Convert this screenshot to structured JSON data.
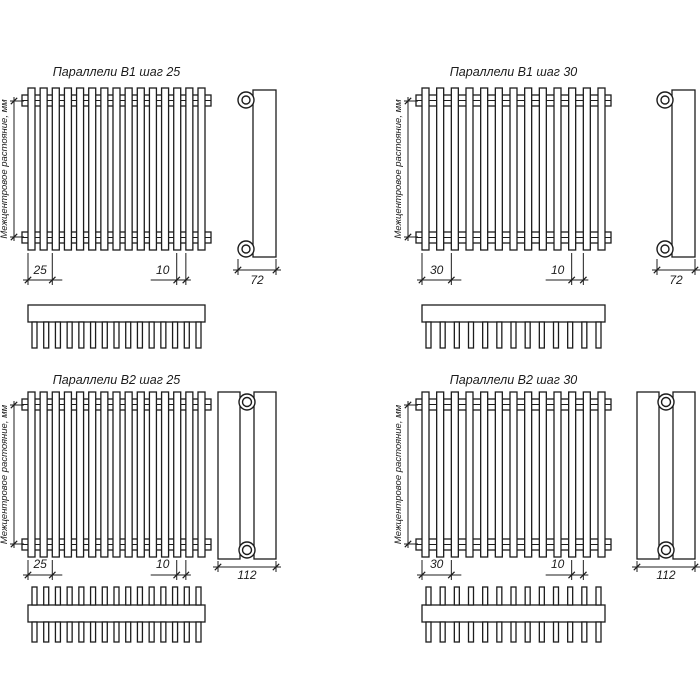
{
  "drawing": {
    "background": "#ffffff",
    "line_color": "#1c1c1c",
    "axis_label": "Межцентровое растояние, мм",
    "panels": [
      {
        "id": "b1-step-25",
        "title": "Параллели В1 шаг 25",
        "model": "В1",
        "step": "25",
        "pitch_label": "25",
        "tube_width_label": "10",
        "depth_label": "72",
        "structure": {
          "rows": 1,
          "tubes": 15,
          "comb_teeth": 15
        }
      },
      {
        "id": "b1-step-30",
        "title": "Параллели В1 шаг 30",
        "model": "В1",
        "step": "30",
        "pitch_label": "30",
        "tube_width_label": "10",
        "depth_label": "72",
        "structure": {
          "rows": 1,
          "tubes": 13,
          "comb_teeth": 13
        }
      },
      {
        "id": "b2-step-25",
        "title": "Параллели В2 шаг 25",
        "model": "В2",
        "step": "25",
        "pitch_label": "25",
        "tube_width_label": "10",
        "depth_label": "112",
        "structure": {
          "rows": 2,
          "tubes": 15,
          "comb_teeth": 15
        }
      },
      {
        "id": "b2-step-30",
        "title": "Параллели В2 шаг 30",
        "model": "В2",
        "step": "30",
        "pitch_label": "30",
        "tube_width_label": "10",
        "depth_label": "112",
        "structure": {
          "rows": 2,
          "tubes": 13,
          "comb_teeth": 13
        }
      }
    ]
  }
}
